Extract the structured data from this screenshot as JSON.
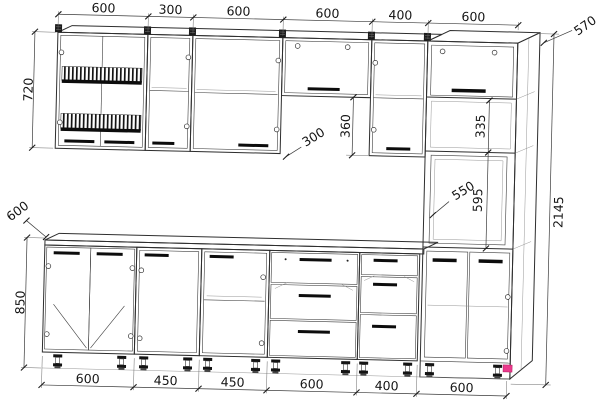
{
  "drawing": {
    "type": "kitchen-cabinet-elevation",
    "units": "mm"
  },
  "dims": {
    "top": [
      "600",
      "300",
      "600",
      "600",
      "400",
      "600"
    ],
    "bottom": [
      "600",
      "450",
      "450",
      "600",
      "400",
      "600"
    ],
    "left": {
      "upper_height": "720",
      "counter_depth": "600",
      "base_height": "850"
    },
    "right": {
      "tall_unit_depth": "570",
      "total_height": "2145"
    },
    "middle": {
      "upper_depth": "300",
      "hood_gap": "360",
      "niche_height": "335",
      "oven_depth": "550",
      "oven_height": "595"
    }
  },
  "colors": {
    "line": "#2e2e2e",
    "marker": "#ea3a8c"
  }
}
